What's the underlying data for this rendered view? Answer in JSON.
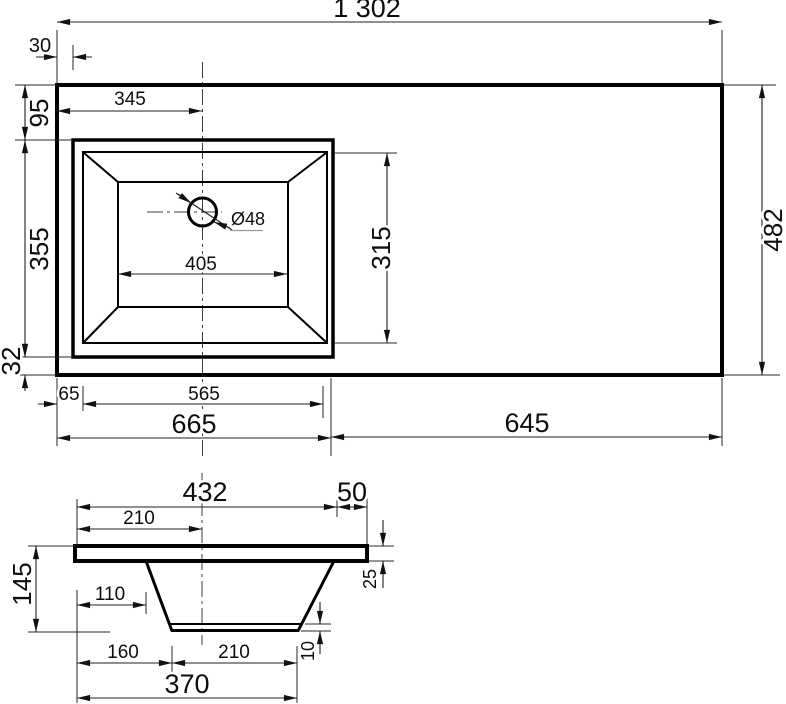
{
  "drawing": {
    "top_view": {
      "overall_width": "1 302",
      "edge_offset": "30",
      "drain_center_from_left": "345",
      "basin_top_margin": "95",
      "basin_outer_depth": "355",
      "basin_bottom_margin": "32",
      "basin_floor_width": "405",
      "drain_diameter": "Ø48",
      "basin_inner_depth": "315",
      "countertop_depth": "482",
      "basin_left_margin": "65",
      "basin_outer_width": "565",
      "left_section_width": "665",
      "right_section_width": "645"
    },
    "section_view": {
      "bowl_top_width": "432",
      "right_edge_offset": "50",
      "center_from_left": "210",
      "total_height": "145",
      "wall_top_offset": "110",
      "slab_thickness": "25",
      "floor_thickness": "10",
      "floor_left_offset": "160",
      "floor_width": "210",
      "bowl_base_width": "370"
    }
  }
}
